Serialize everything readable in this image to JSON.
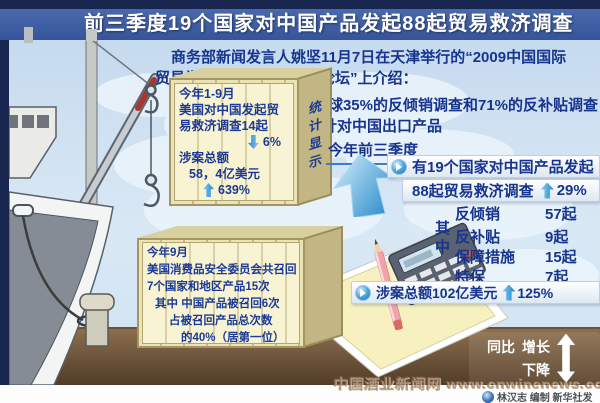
{
  "title": "前三季度19个国家对中国产品发起88起贸易救济调查",
  "intro": {
    "line1": "商务部新闻发言人姚坚11月7日在天津举行的“2009中国国际",
    "line2": "贸易学会暨国际贸易发展论坛”上介绍：",
    "line3": "目前全球35%的反倾销调查和71%的反补贴调查",
    "line4": "针对中国出口产品"
  },
  "crate_top": {
    "side_label": "统计显示",
    "line1": "今年1-9月",
    "line2": "美国对中国发起贸",
    "line3": "易救济调查14起",
    "drop_value": "6%",
    "amount_label": "涉案总额",
    "amount_value": "58，4亿美元",
    "rise_value": "639%"
  },
  "main": {
    "period": "今年前三季度",
    "headline_line1": "有19个国家对中国产品发起",
    "headline_line2": "88起贸易救济调查",
    "headline_rise": "29%",
    "among": "其中",
    "breakdown": [
      {
        "label": "反倾销",
        "value": "57起"
      },
      {
        "label": "反补贴",
        "value": "9起"
      },
      {
        "label": "保障措施",
        "value": "15起"
      },
      {
        "label": "特保",
        "value": "7起"
      }
    ],
    "amount_line": "涉案总额102亿美元",
    "amount_rise": "125%"
  },
  "crate_bottom": {
    "line1": "今年9月",
    "line2": "美国消费品安全委员会共召回",
    "line3": "7个国家和地区产品15次",
    "line4": "其中 中国产品被召回6次",
    "line5": "占被召回产品总次数",
    "line6": "的40%（居第一位）"
  },
  "legend": {
    "prefix": "同比",
    "up": "增长",
    "down": "下降"
  },
  "watermark": {
    "site": "中国酒业新闻网 www.cnwinenews.com",
    "credit": "林汉志 编制 新华社发"
  },
  "chart_data": {
    "type": "table",
    "title": "前三季度19个国家对中国产品发起88起贸易救济调查",
    "columns": [
      "类型",
      "数量"
    ],
    "rows": [
      [
        "反倾销",
        "57起"
      ],
      [
        "反补贴",
        "9起"
      ],
      [
        "保障措施",
        "15起"
      ],
      [
        "特保",
        "7起"
      ]
    ],
    "total_cases": "88起",
    "total_cases_change": "+29%",
    "amount": "102亿美元",
    "amount_change": "+125%",
    "us_cases_jan_sep": "14起",
    "us_cases_change": "-6%",
    "us_amount": "58.4亿美元",
    "us_amount_change": "+639%"
  },
  "colors": {
    "accent_blue": "#1b86cc",
    "navy_text": "#16348e",
    "title_bar": "#3e5ea2",
    "ground_brown": "#7a5c3e"
  }
}
